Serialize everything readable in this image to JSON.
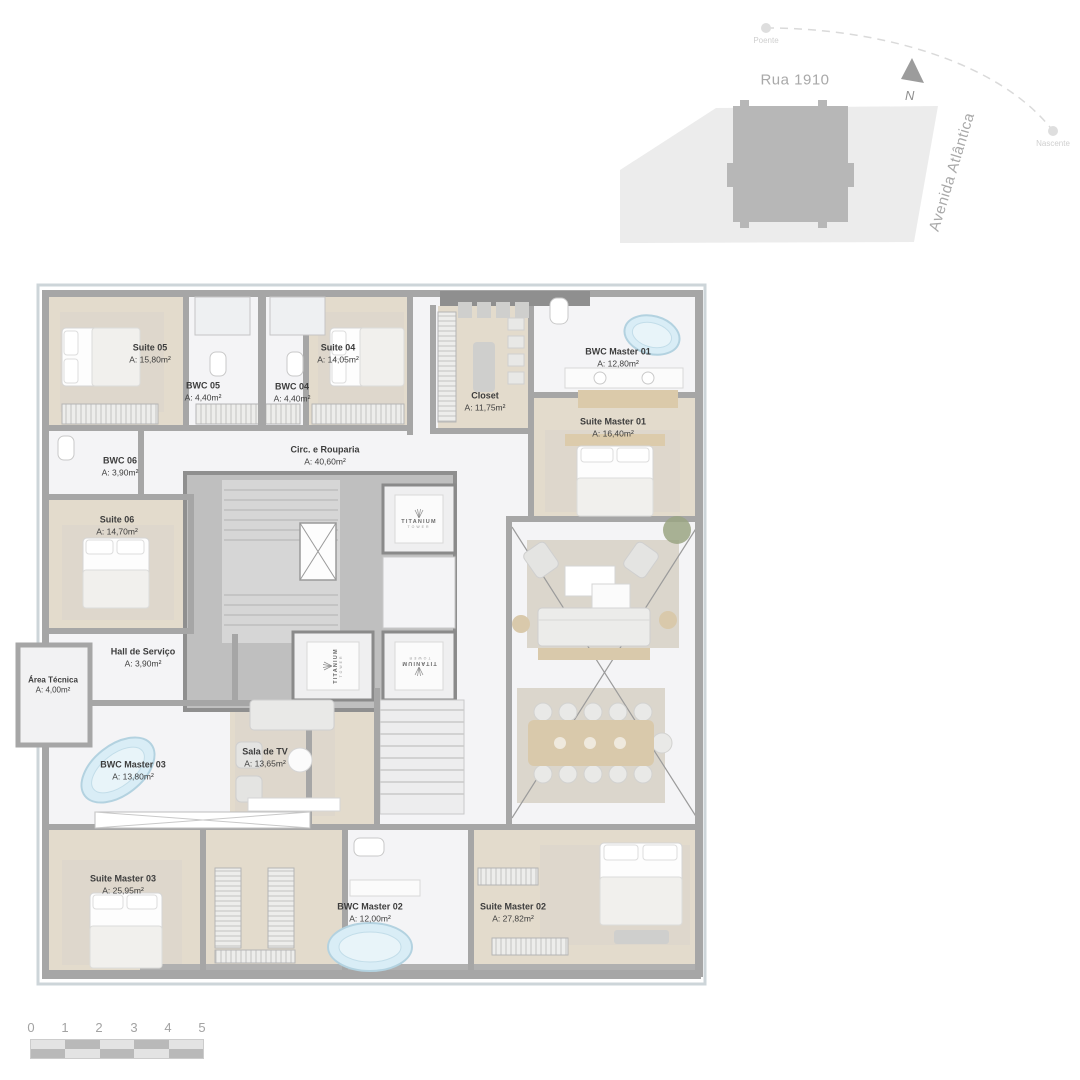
{
  "site_map": {
    "street_top": "Rua 1910",
    "street_right": "Avenida Atlântica",
    "sun_west": "Poente",
    "sun_east": "Nascente",
    "north_label": "N"
  },
  "brand": {
    "elevator_logo": "TITANIUM",
    "elevator_logo_sub": "TOWER"
  },
  "rooms": [
    {
      "name": "Suite 05",
      "area": "A: 15,80m²"
    },
    {
      "name": "BWC 05",
      "area": "A: 4,40m²"
    },
    {
      "name": "BWC 04",
      "area": "A: 4,40m²"
    },
    {
      "name": "Suite 04",
      "area": "A: 14,05m²"
    },
    {
      "name": "Closet",
      "area": "A: 11,75m²"
    },
    {
      "name": "BWC Master 01",
      "area": "A: 12,80m²"
    },
    {
      "name": "Suite Master 01",
      "area": "A: 16,40m²"
    },
    {
      "name": "BWC 06",
      "area": "A: 3,90m²"
    },
    {
      "name": "Circ. e Rouparia",
      "area": "A: 40,60m²"
    },
    {
      "name": "Suite 06",
      "area": "A: 14,70m²"
    },
    {
      "name": "Hall de Serviço",
      "area": "A: 3,90m²"
    },
    {
      "name": "Área Técnica",
      "area": "A: 4,00m²"
    },
    {
      "name": "BWC Master 03",
      "area": "A: 13,80m²"
    },
    {
      "name": "Sala de TV",
      "area": "A: 13,65m²"
    },
    {
      "name": "Suite Master 03",
      "area": "A: 25,95m²"
    },
    {
      "name": "BWC Master 02",
      "area": "A: 12,00m²"
    },
    {
      "name": "Suite Master 02",
      "area": "A: 27,82m²"
    }
  ],
  "scale_bar": {
    "ticks": [
      "0",
      "1",
      "2",
      "3",
      "4",
      "5"
    ]
  },
  "colors": {
    "wall": "#a6a6a6",
    "wall_dark": "#8f8f8f",
    "wood_floor": "#e3dbcc",
    "marble_floor": "#f4f4f6",
    "core": "#bfbfbf",
    "tub_water": "#d9edf6",
    "wood_furniture": "#d9c9ab",
    "site_lot": "#ececec",
    "site_building": "#b7b7b7"
  }
}
